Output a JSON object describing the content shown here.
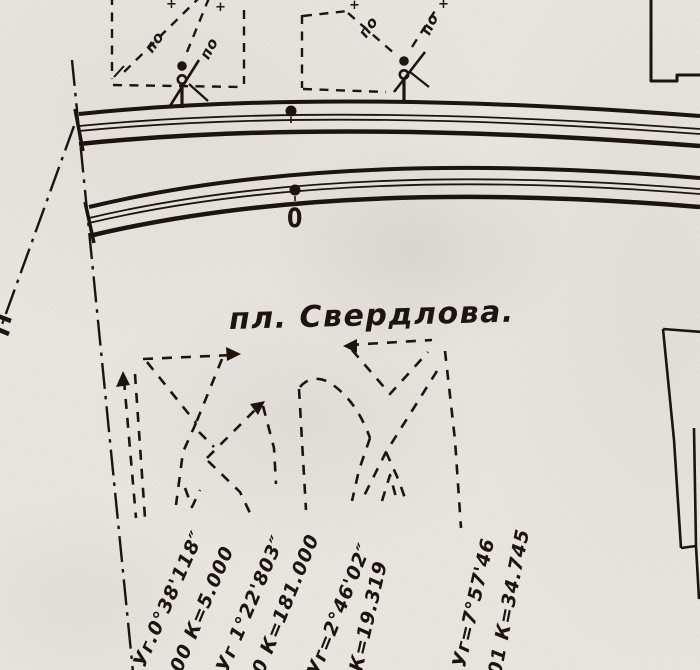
{
  "colors": {
    "ink": "#1d140b",
    "paper": "#e9e6e1"
  },
  "labels": {
    "square": "пл. Свердлова.",
    "zero": "0"
  },
  "pole_labels": [
    {
      "text": "по"
    },
    {
      "text": "по"
    },
    {
      "text": "по"
    },
    {
      "text": "по"
    }
  ],
  "plus_marks": [
    {
      "text": "+"
    },
    {
      "text": "+"
    },
    {
      "text": "+"
    },
    {
      "text": "+"
    }
  ],
  "annotations": [
    {
      "text": "Уг.0°38'118″"
    },
    {
      "text": "00 К=5.000"
    },
    {
      "text": "Уг 1°22'803″"
    },
    {
      "text": "0 К=181.000"
    },
    {
      "text": "Уг=2°46'02″"
    },
    {
      "text": "К=19.319"
    },
    {
      "text": "Уг=7°57'46"
    },
    {
      "text": "01 К=34.745"
    }
  ]
}
